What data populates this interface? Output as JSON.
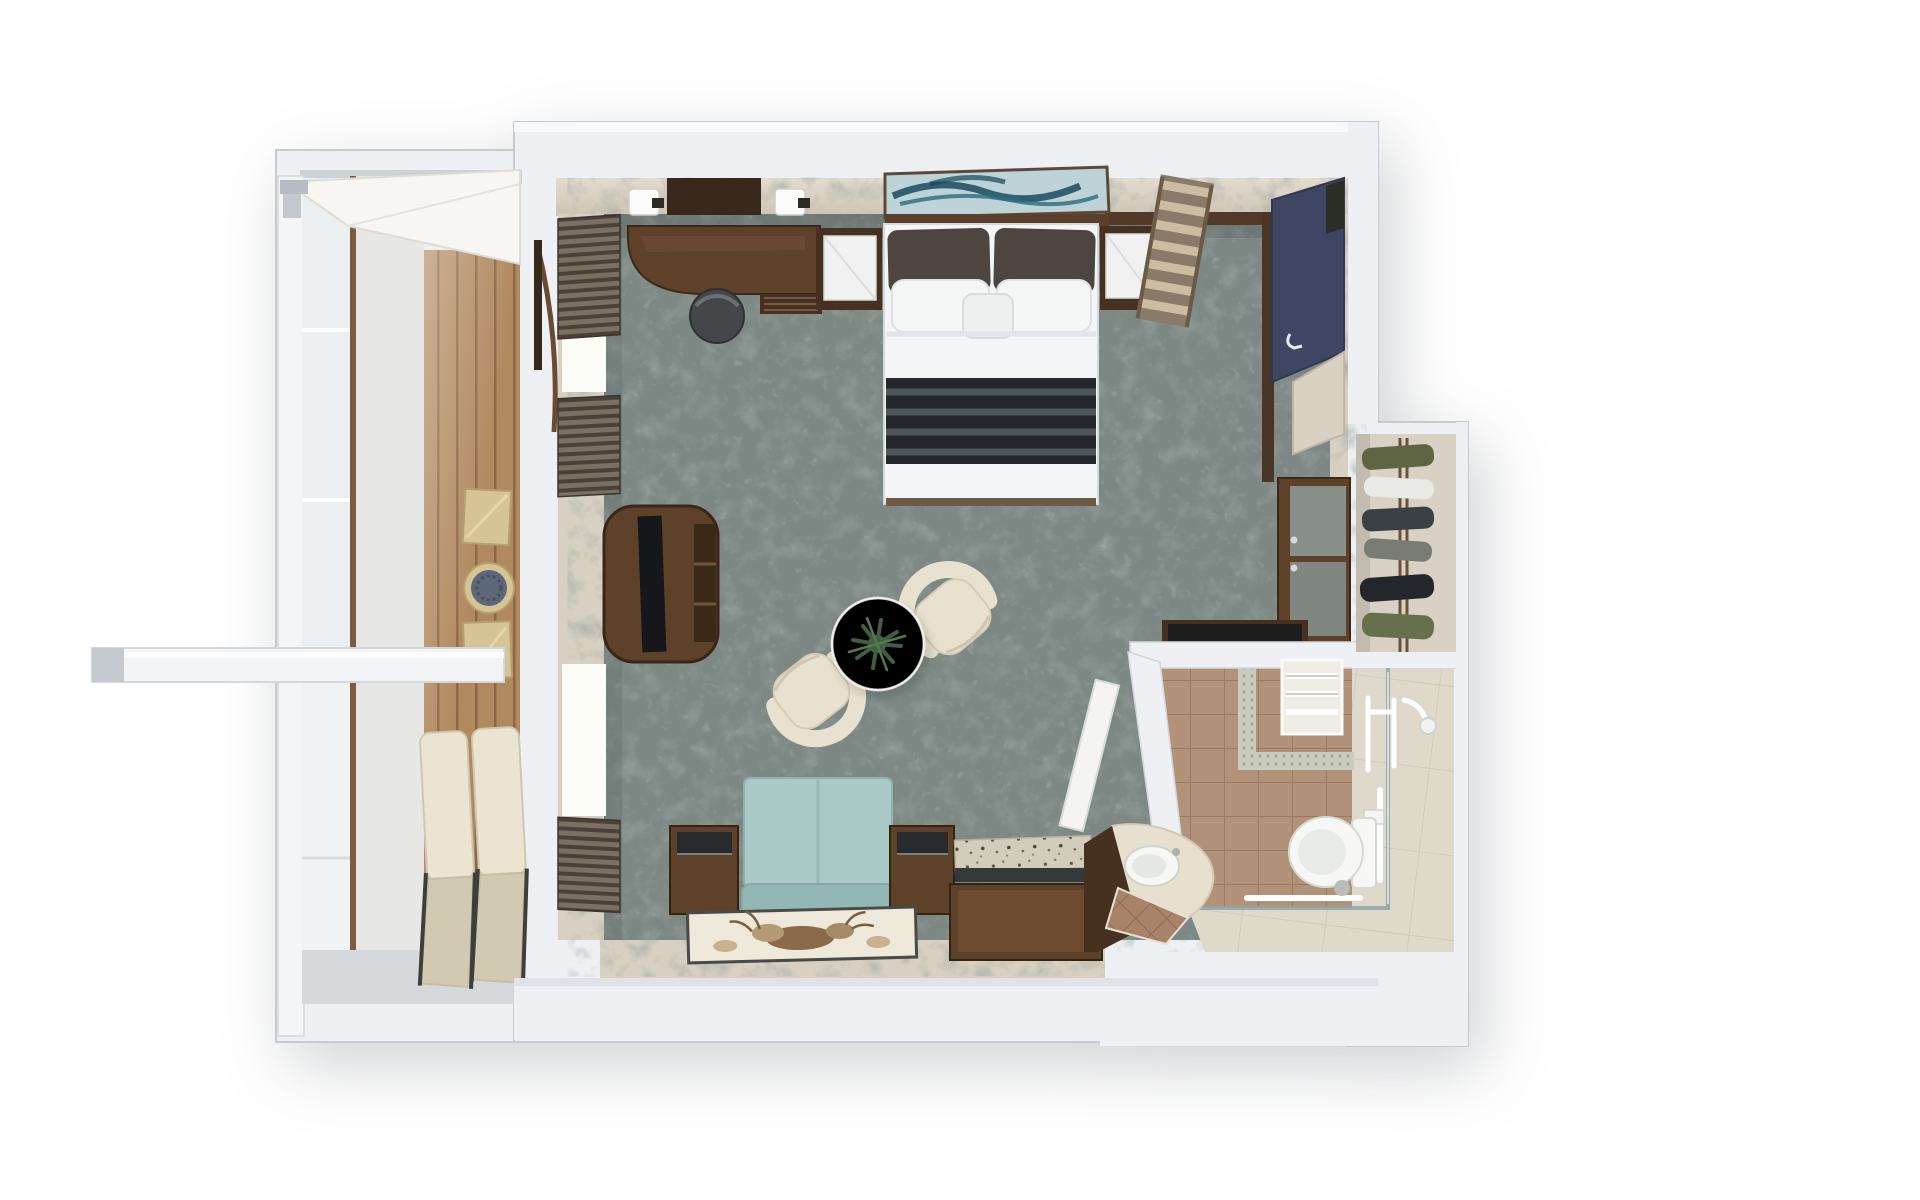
{
  "scene": {
    "description": "3D top-down dollhouse render of a cruise ship balcony suite floor plan",
    "style": "photorealistic overhead render, no text labels",
    "background": "#ffffff"
  },
  "colors": {
    "wall": "#eef0f3",
    "wall_edge": "#c6cbd2",
    "wall_shade": "#d9dde2",
    "beige_wall": "#d8d0c2",
    "beige_dark": "#c3b9a9",
    "carpet": "#7d8884",
    "wood_dark": "#46301f",
    "wood_mid": "#5e4129",
    "wood_face": "#6e4a30",
    "bed_white": "#f3f5f6",
    "pillow_brown": "#4e4540",
    "runner_dark": "#24282c",
    "runner_stripe": "#555d62",
    "art_bg": "#bdd3d8",
    "art_ink": "#1c4a5e",
    "navy": "#3e4663",
    "sofa_teal": "#a9c9c6",
    "sofa_teal_dark": "#93b7b4",
    "cream": "#e8e1cf",
    "cream_dark": "#d2c9b2",
    "plant": "#47684c",
    "granite": "#d2ccba",
    "glass_track": "#8fa3a9",
    "fixture": "#f7f8f6",
    "deck_wood": "#b1895f",
    "lounger": "#ebe4d1",
    "gold": "#d6c494",
    "rattan_top": "#5c6777",
    "glass": "#eceff1",
    "window_light": "#fdfdf8",
    "door_white": "#f4f5f2",
    "chair_grey": "#43474a"
  },
  "rooms": {
    "balcony": {
      "label": "Balcony",
      "items": [
        "canopy-awning",
        "privacy-divider",
        "glass-balustrade",
        "wood-deck",
        "gold-cube-table-1",
        "round-rattan-table",
        "gold-cube-table-2",
        "sun-lounger-1",
        "sun-lounger-2"
      ]
    },
    "bedroom": {
      "label": "Bedroom",
      "items": [
        "wall-lamp-left",
        "wall-mirror-panel",
        "wall-lamp-right",
        "writing-desk",
        "desk-stool",
        "nightstand-left",
        "seascape-artwork",
        "double-bed",
        "bed-runner",
        "nightstand-right",
        "slatted-luggage-rack",
        "navy-wardrobe",
        "wardrobe-safe",
        "dresser",
        "minibar-counter"
      ]
    },
    "living_area": {
      "label": "Sitting area",
      "items": [
        "tv-console",
        "window-blinds",
        "tub-chair-1",
        "cocktail-table",
        "potted-plant",
        "tub-chair-2",
        "loveseat-sofa",
        "cube-side-table-left",
        "cube-side-table-right",
        "granite-vanity-desk",
        "deer-artwork-panel"
      ]
    },
    "bathroom": {
      "label": "Bathroom",
      "items": [
        "bathroom-door",
        "towel-rack",
        "mosaic-border",
        "shower-glass-screen",
        "shower-fixtures",
        "grab-bars",
        "toilet",
        "vanity-counter",
        "sink",
        "tiled-step",
        "marble-entry-floor"
      ]
    },
    "closet": {
      "label": "Walk-in closet",
      "items": [
        "clothes-rail",
        "hanging-garments"
      ]
    }
  }
}
